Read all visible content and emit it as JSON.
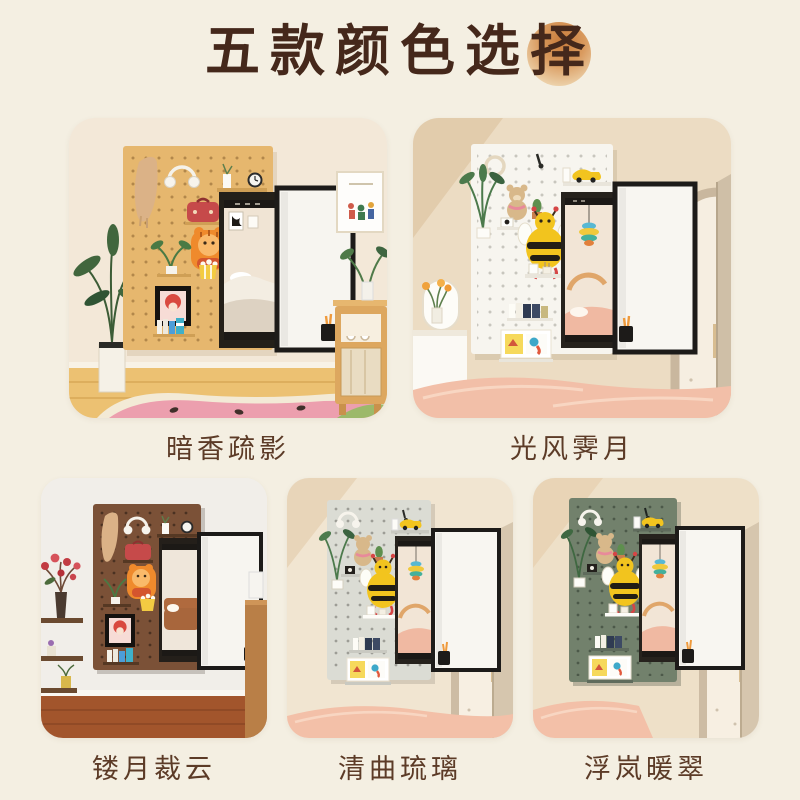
{
  "page": {
    "background_color": "#f4efe2"
  },
  "title": {
    "text": "五款颜色选择",
    "text_color": "#45281b",
    "accent_circle_color": "#c87b3a"
  },
  "mirror": {
    "frame_color": "#1d1b19",
    "panel_color": "#f7f5f0"
  },
  "options": [
    {
      "name": "暗香疏影",
      "board_color": "#e6b76e",
      "wall_color": "#f3e8d8",
      "floor_color": "#ecc172"
    },
    {
      "name": "光风霁月",
      "board_color": "#f7f5ef",
      "wall_color": "#ecdcc3",
      "floor_color": "#f2bfa8"
    },
    {
      "name": "镂月裁云",
      "board_color": "#7b5137",
      "wall_color": "#f1eee9",
      "floor_color": "#a2552c"
    },
    {
      "name": "清曲琉璃",
      "board_color": "#dbdcd4",
      "wall_color": "#f1e5d1",
      "floor_color": "#f3c0a8"
    },
    {
      "name": "浮岚暖翠",
      "board_color": "#72816c",
      "wall_color": "#eee0c8",
      "floor_color": "#f3c0a8"
    }
  ]
}
